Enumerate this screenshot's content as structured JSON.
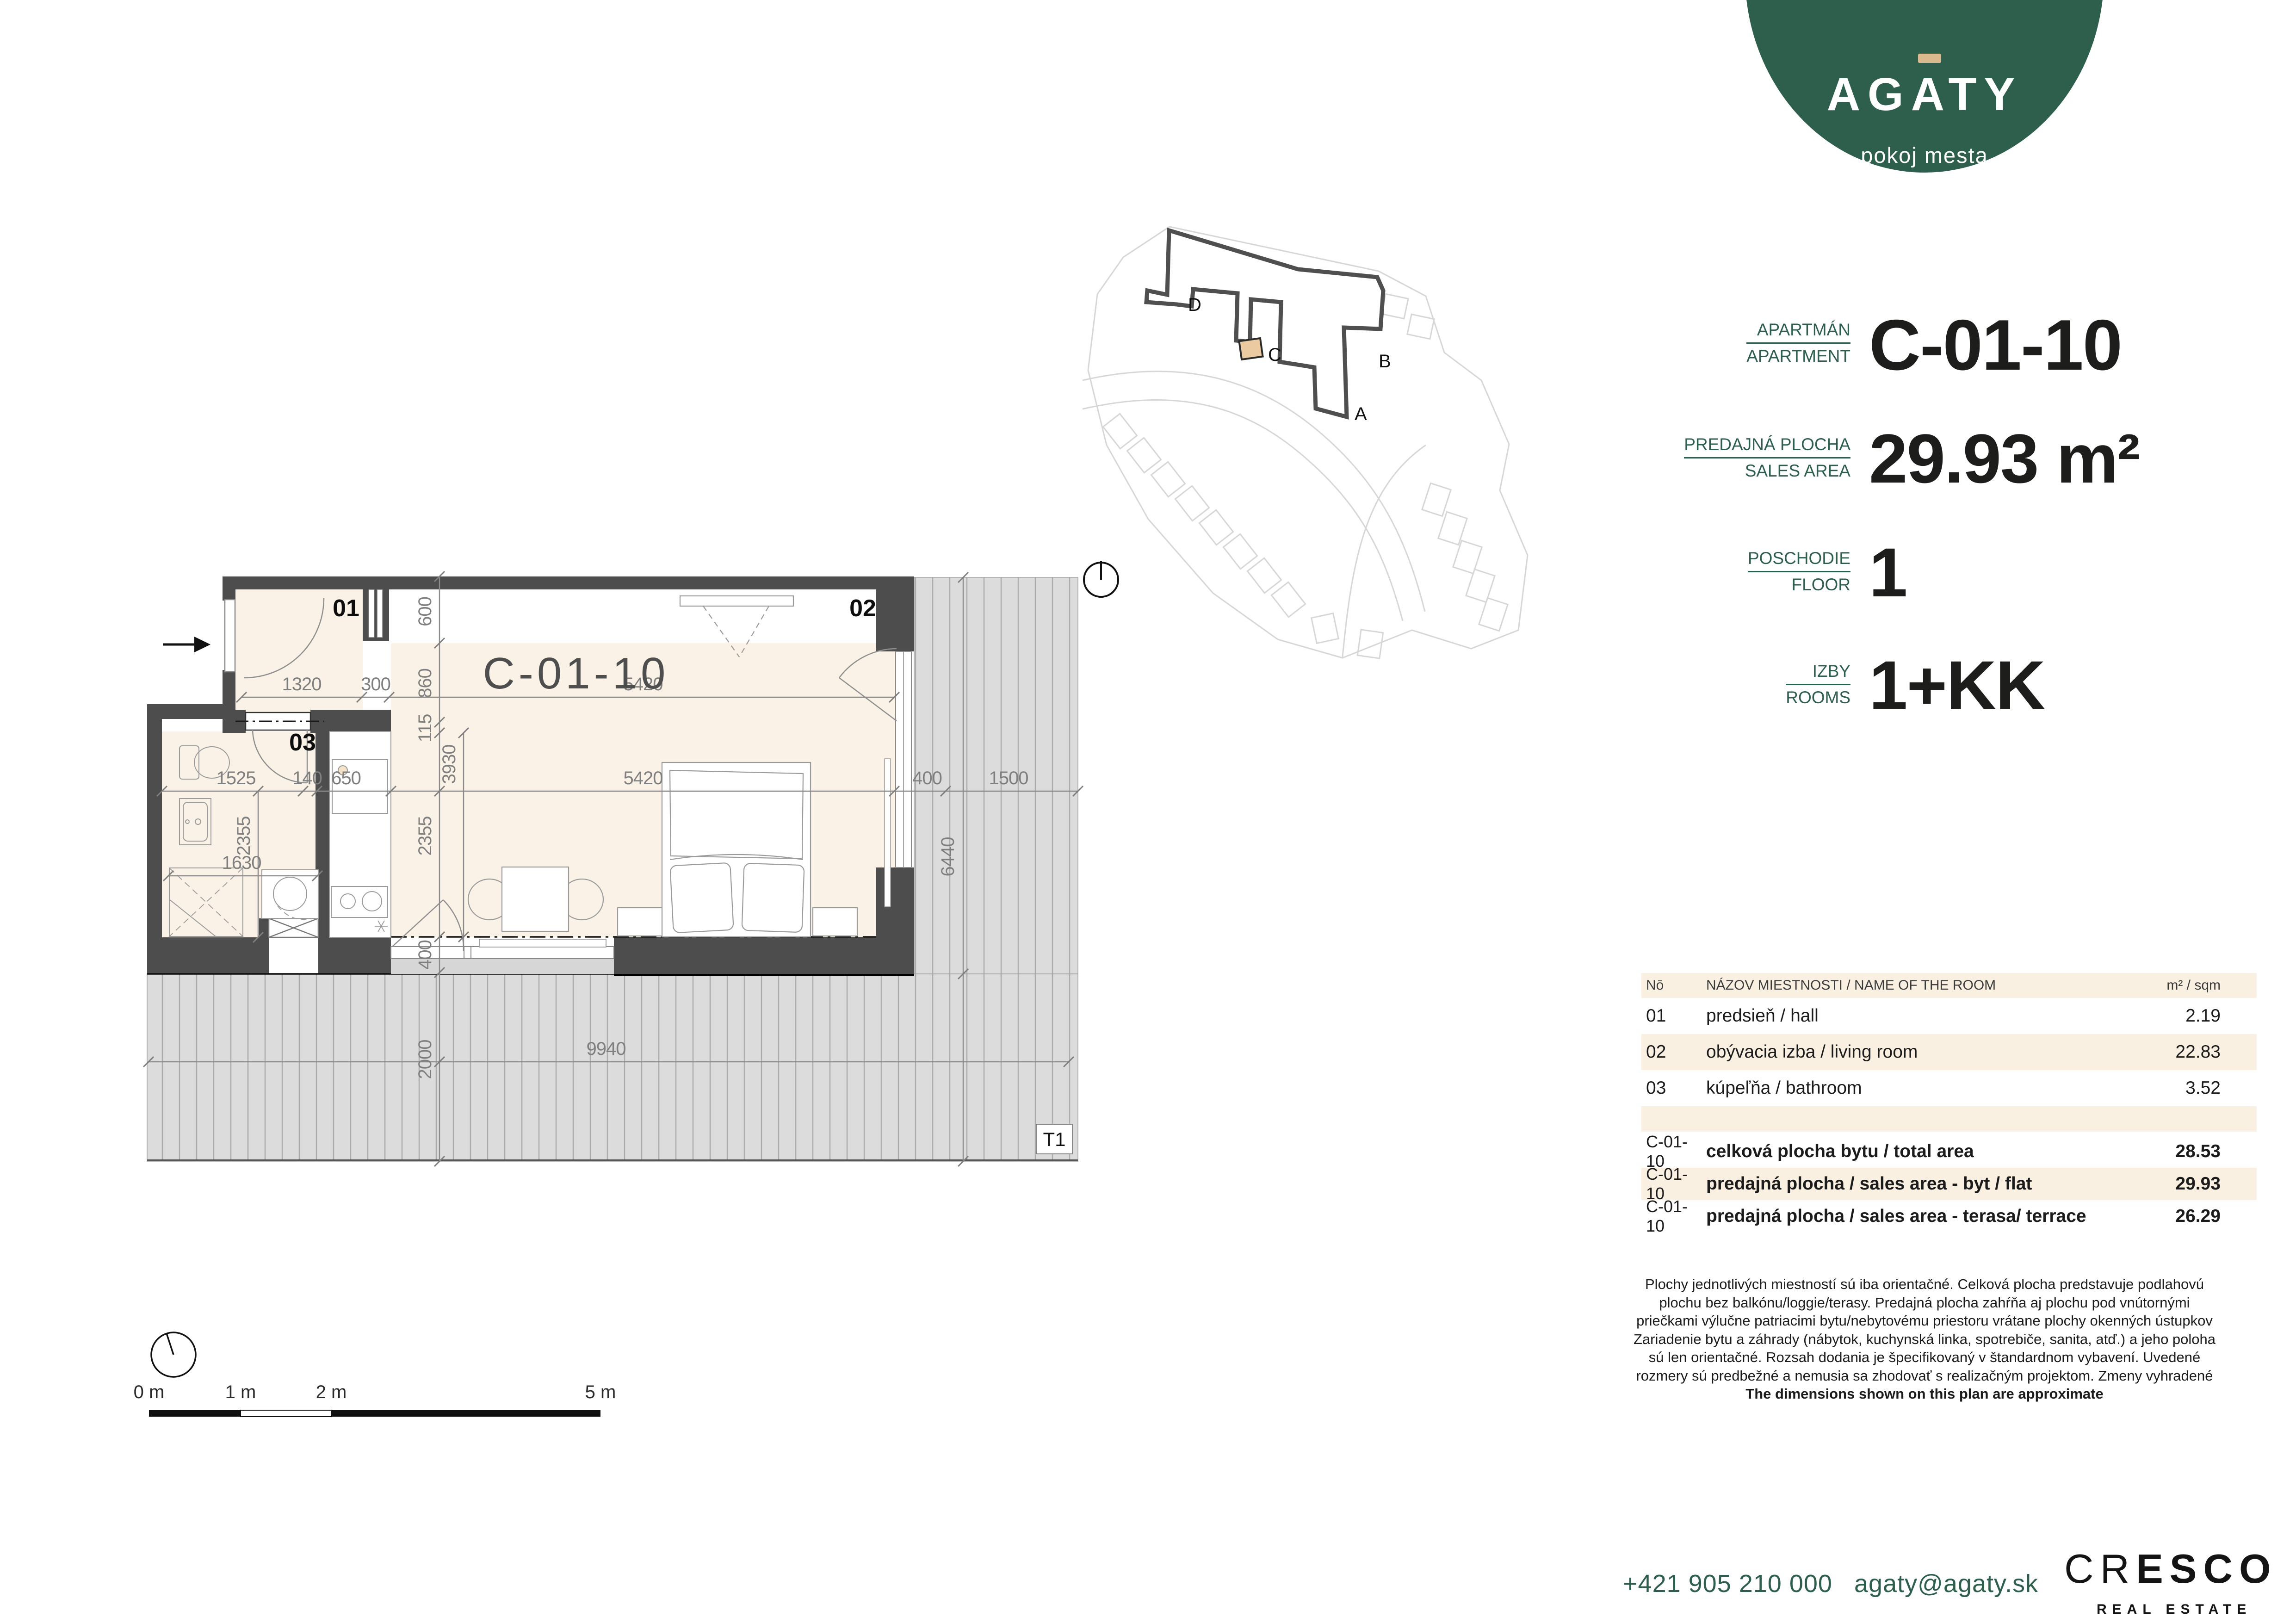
{
  "logo": {
    "name": "AGATY",
    "tagline": "pokoj mesta",
    "green": "#2e5e4c",
    "macron": "#d9b98d"
  },
  "info": {
    "rows": [
      {
        "label_sk": "APARTMÁN",
        "label_en": "APARTMENT",
        "value": "C-01-10"
      },
      {
        "label_sk": "PREDAJNÁ PLOCHA",
        "label_en": "SALES AREA",
        "value": "29.93 m²"
      },
      {
        "label_sk": "POSCHODIE",
        "label_en": "FLOOR",
        "value": "1"
      },
      {
        "label_sk": "IZBY",
        "label_en": "ROOMS",
        "value": "1+KK"
      }
    ]
  },
  "site": {
    "labels": {
      "a": "A",
      "b": "B",
      "c": "C",
      "d": "D"
    }
  },
  "plan": {
    "unit": "C-01-10",
    "rooms": {
      "r01": "01",
      "r02": "02",
      "r03": "03"
    },
    "terrace": "T1",
    "dims": {
      "h1_1320": "1320",
      "h1_300": "300",
      "h1_5420": "5420",
      "h2_1525": "1525",
      "h2_140": "140",
      "h2_650": "650",
      "h2_5420": "5420",
      "h2_400": "400",
      "h2_1500": "1500",
      "v_600": "600",
      "v_860": "860",
      "v_115": "115",
      "v_3930": "3930",
      "v_2355a": "2355",
      "v_2355b": "2355",
      "v_400": "400",
      "v_2000": "2000",
      "v_6440": "6440",
      "b_1630": "1630",
      "t_9940": "9940"
    }
  },
  "scalebar": {
    "l0": "0 m",
    "l1": "1 m",
    "l2": "2 m",
    "l5": "5 m"
  },
  "table": {
    "headers": {
      "no": "Nō",
      "name": "NÁZOV MIESTNOSTI / NAME OF THE ROOM",
      "area": "m² / sqm"
    },
    "rooms": [
      {
        "no": "01",
        "name": "predsieň / hall",
        "area": "2.19"
      },
      {
        "no": "02",
        "name": "obývacia izba / living room",
        "area": "22.83"
      },
      {
        "no": "03",
        "name": "kúpeľňa / bathroom",
        "area": "3.52"
      }
    ],
    "totals": [
      {
        "no": "C-01-10",
        "name": "celková plocha bytu / total area",
        "area": "28.53"
      },
      {
        "no": "C-01-10",
        "name": "predajná plocha / sales area - byt / flat",
        "area": "29.93"
      },
      {
        "no": "C-01-10",
        "name": "predajná plocha / sales area - terasa/ terrace",
        "area": "26.29"
      }
    ]
  },
  "disclaimer": {
    "lines": [
      "Plochy jednotlivých miestností sú iba orientačné. Celková plocha predstavuje podlahovú",
      "plochu bez balkónu/loggie/terasy. Predajná plocha zahŕňa aj plochu pod vnútornými",
      "priečkami výlučne patriacimi bytu/nebytovému priestoru vrátane plochy okenných ústupkov",
      "Zariadenie bytu a záhrady (nábytok, kuchynská linka, spotrebiče, sanita, atď.) a jeho poloha",
      "sú len orientačné. Rozsah dodania je špecifikovaný v štandardnom vybavení. Uvedené",
      "rozmery sú predbežné a nemusia sa zhodovať s realizačným projektom. Zmeny vyhradené",
      "The dimensions shown on this plan are approximate"
    ]
  },
  "footer": {
    "phone": "+421 905 210 000",
    "email": "agaty@agaty.sk",
    "cresco_thin": "CR",
    "cresco_bold": "ESCO",
    "cresco_sub": "REAL ESTATE"
  }
}
